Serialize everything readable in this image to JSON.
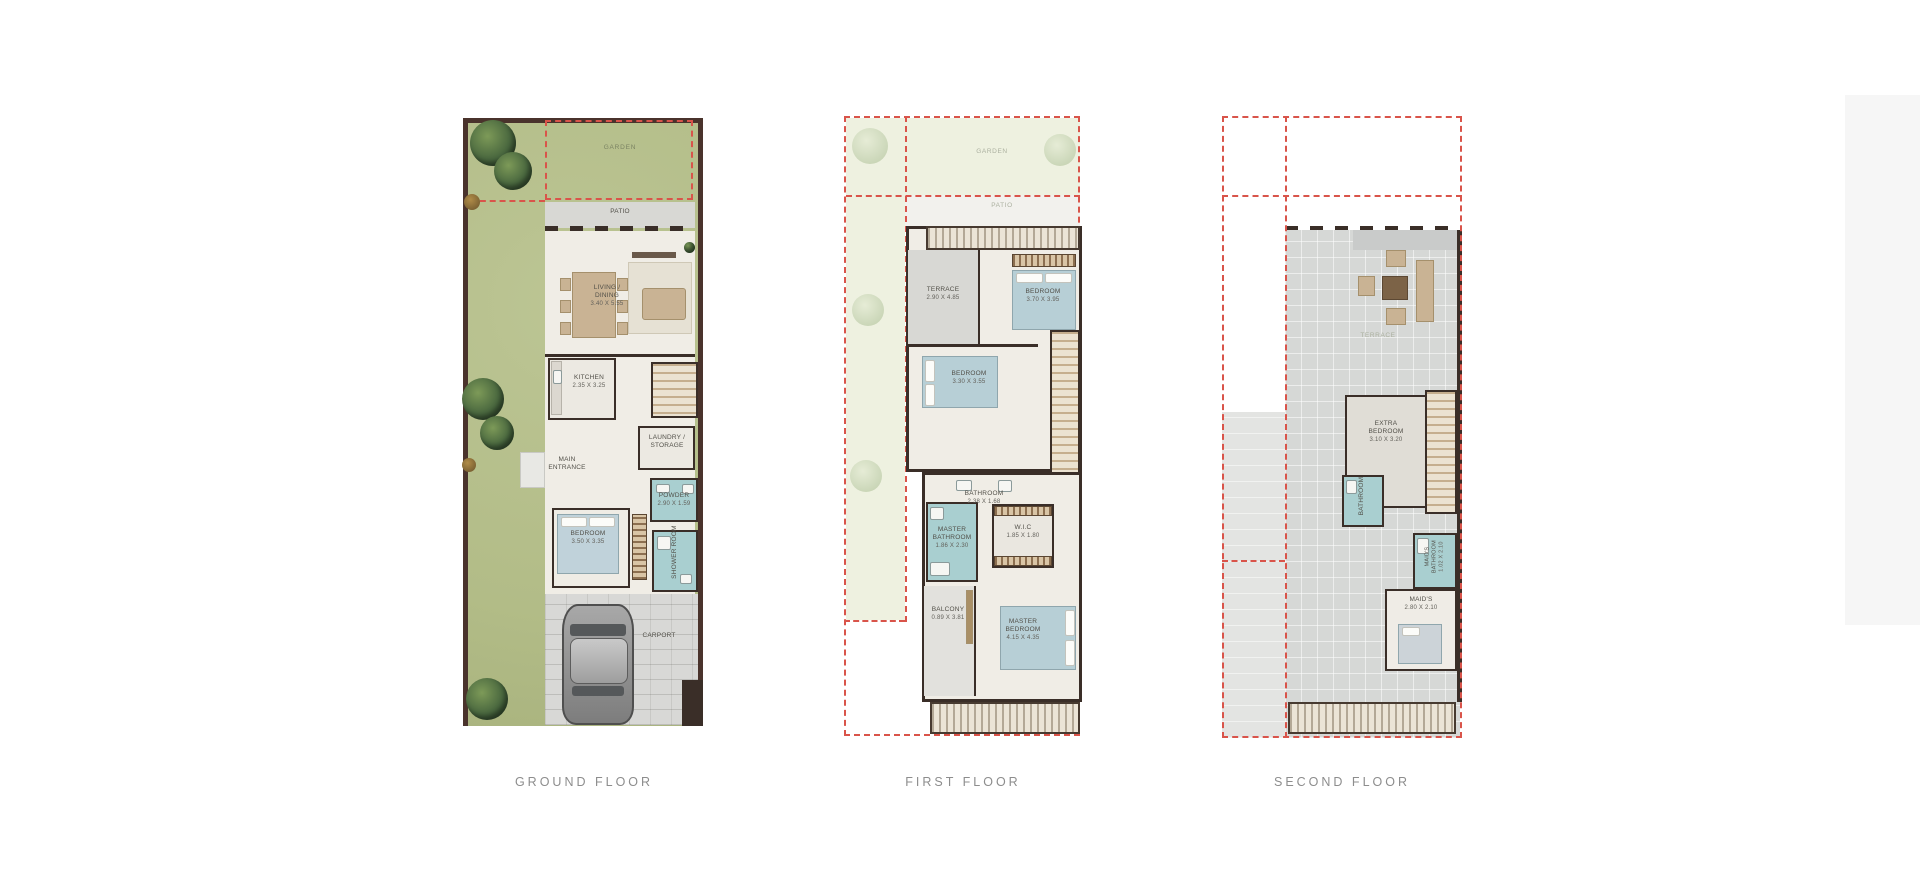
{
  "sheet": {
    "background": "#ffffff",
    "dash_color": "#d9544a",
    "wall_color": "#3a2e28",
    "garden_green": "#b2bc87",
    "interior_color": "#f0ede6",
    "wet_room_teal": "#a9cfd0",
    "title_color": "#8d8d8d"
  },
  "floors": {
    "ground": {
      "title": "GROUND FLOOR",
      "garden": "GARDEN",
      "patio": "PATIO",
      "living": {
        "name": "LIVING /\nDINING",
        "dims": "3.40 X 5.55"
      },
      "kitchen": {
        "name": "KITCHEN",
        "dims": "2.35 X 3.25"
      },
      "laundry": {
        "name": "LAUNDRY /\nSTORAGE"
      },
      "entrance": {
        "name": "MAIN\nENTRANCE"
      },
      "powder": {
        "name": "POWDER",
        "dims": "2.90 X 1.59"
      },
      "bedroom": {
        "name": "BEDROOM",
        "dims": "3.50 X 3.35"
      },
      "shower": {
        "name": "SHOWER ROOM"
      },
      "carport": {
        "name": "CARPORT"
      }
    },
    "first": {
      "title": "FIRST FLOOR",
      "garden": "GARDEN",
      "patio": "PATIO",
      "terrace": {
        "name": "TERRACE",
        "dims": "2.90 X 4.85"
      },
      "bedroom1": {
        "name": "BEDROOM",
        "dims": "3.70 X 3.95"
      },
      "bedroom2": {
        "name": "BEDROOM",
        "dims": "3.30 X 3.55"
      },
      "bathroom": {
        "name": "BATHROOM",
        "dims": "2.38 X 1.68"
      },
      "master_bathroom": {
        "name": "MASTER\nBATHROOM",
        "dims": "1.86 X 2.30"
      },
      "wic": {
        "name": "W.I.C",
        "dims": "1.85 X 1.80"
      },
      "master_bedroom": {
        "name": "MASTER\nBEDROOM",
        "dims": "4.15 X 4.35"
      },
      "balcony": {
        "name": "BALCONY",
        "dims": "0.89 X 3.81"
      }
    },
    "second": {
      "title": "SECOND FLOOR",
      "terrace": {
        "name": "TERRACE"
      },
      "extra_bedroom": {
        "name": "EXTRA\nBEDROOM",
        "dims": "3.10 X 3.20"
      },
      "bathroom": {
        "name": "BATHROOM"
      },
      "maids_bathroom": {
        "name": "MAID'S\nBATHROOM",
        "dims": "1.02 X 2.10"
      },
      "maids": {
        "name": "MAID'S",
        "dims": "2.80 X 2.10"
      }
    }
  }
}
